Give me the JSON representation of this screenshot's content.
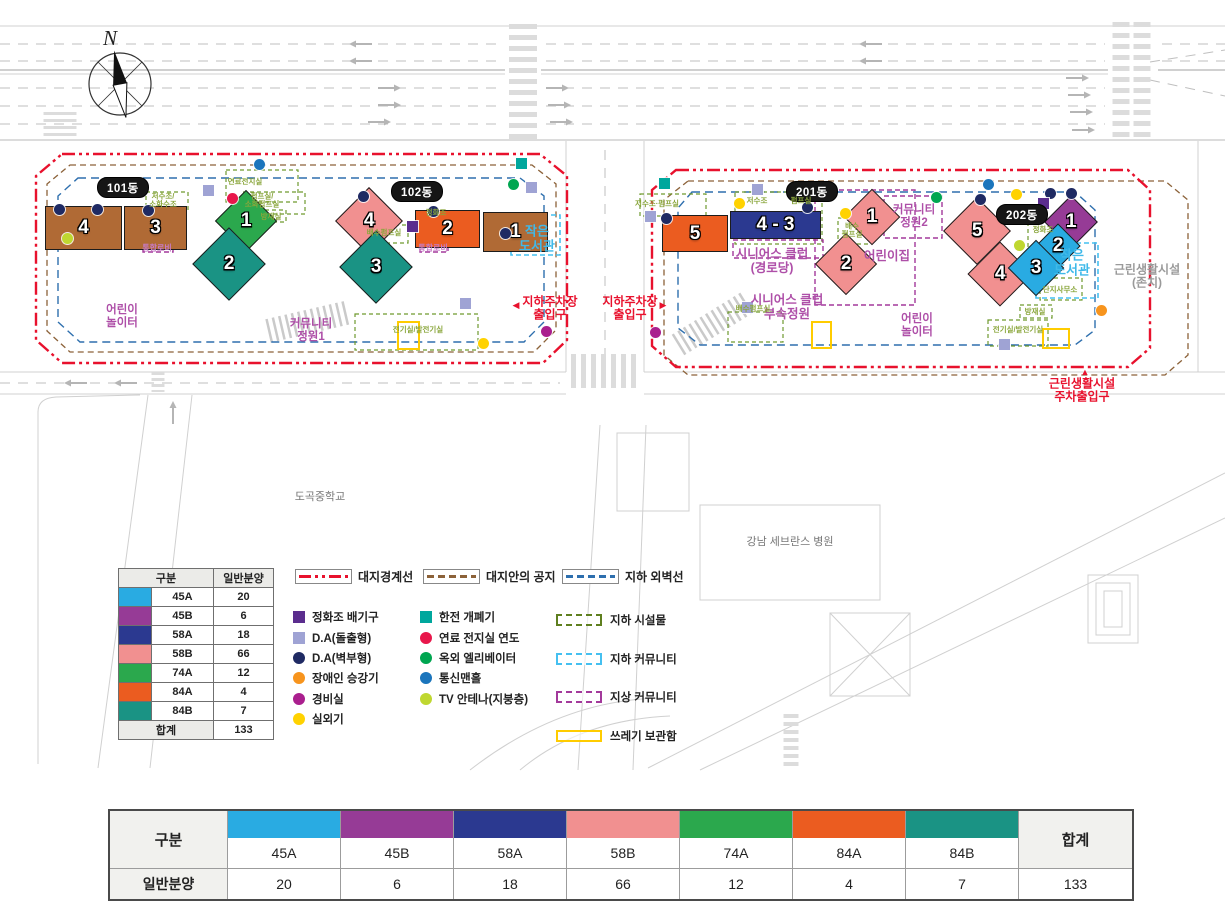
{
  "compass": {
    "label": "N"
  },
  "palette": {
    "boundary_red": "#E8112D",
    "setback_brown": "#8C6239",
    "basement_blue": "#2E6FAE",
    "rental_brown": "#B06A35"
  },
  "units": [
    {
      "type": "45A",
      "color": "#29ABE2",
      "sale": "20"
    },
    {
      "type": "45B",
      "color": "#963B96",
      "sale": "6"
    },
    {
      "type": "58A",
      "color": "#2B3990",
      "sale": "18"
    },
    {
      "type": "58B",
      "color": "#F19090",
      "sale": "66"
    },
    {
      "type": "74A",
      "color": "#2BA84D",
      "sale": "12"
    },
    {
      "type": "84A",
      "color": "#EB5C20",
      "sale": "4"
    },
    {
      "type": "84B",
      "color": "#1A9384",
      "sale": "7"
    }
  ],
  "legend_table": {
    "header_type": "구분",
    "header_sale": "일반분양",
    "total_label": "합계",
    "total_value": "133"
  },
  "bottom_table": {
    "row_type_label": "구분",
    "row_sale_label": "일반분양",
    "total_label": "합계",
    "total_value": "133"
  },
  "legend_lines": [
    {
      "id": "site-boundary",
      "label": "대지경계선",
      "color": "#E8112D",
      "style": "dashdot",
      "x": 295
    },
    {
      "id": "site-open-space",
      "label": "대지안의 공지",
      "color": "#8C6239",
      "style": "dash",
      "x": 423
    },
    {
      "id": "basement-wall",
      "label": "지하 외벽선",
      "color": "#2E6FAE",
      "style": "dash",
      "x": 562
    }
  ],
  "legend_symbols_left": [
    {
      "id": "septic-vent",
      "shape": "square",
      "color": "#5B2D8E",
      "label": "정화조 배기구"
    },
    {
      "id": "da-protruding",
      "shape": "square",
      "color": "#9FA3D4",
      "label": "D.A(돌출형)"
    },
    {
      "id": "da-wall",
      "shape": "circle",
      "color": "#1F2A63",
      "label": "D.A(벽부형)"
    },
    {
      "id": "disabled-lift",
      "shape": "circle",
      "color": "#F7941D",
      "label": "장애인 승강기"
    },
    {
      "id": "guard-room",
      "shape": "circle",
      "color": "#AA1F8E",
      "label": "경비실"
    },
    {
      "id": "outdoor-unit",
      "shape": "circle",
      "color": "#FFD200",
      "label": "실외기"
    }
  ],
  "legend_symbols_right": [
    {
      "id": "kepco-switch",
      "shape": "square",
      "color": "#00A79D",
      "label": "한전 개폐기"
    },
    {
      "id": "fuel-cell-flue",
      "shape": "circle",
      "color": "#E8174B",
      "label": "연료 전지실 연도"
    },
    {
      "id": "outdoor-elevator",
      "shape": "circle",
      "color": "#00A651",
      "label": "옥외 엘리베이터"
    },
    {
      "id": "comm-manhole",
      "shape": "circle",
      "color": "#1B75BC",
      "label": "통신맨홀"
    },
    {
      "id": "tv-antenna",
      "shape": "circle",
      "color": "#BFD730",
      "label": "TV 안테나(지붕층)"
    }
  ],
  "legend_areas": [
    {
      "id": "underground-facility",
      "color": "#5E7F1F",
      "style": "dashed",
      "label": "지하 시설물"
    },
    {
      "id": "underground-community",
      "color": "#45C0F0",
      "style": "dashed",
      "label": "지하 커뮤니티"
    },
    {
      "id": "ground-community",
      "color": "#A3399B",
      "style": "dashed",
      "label": "지상 커뮤니티"
    },
    {
      "id": "trash-storage",
      "color": "#FFCC00",
      "style": "solid",
      "label": "쓰레기 보관함"
    }
  ],
  "site": {
    "badges": [
      {
        "block": "101",
        "label": "101동",
        "x": 97,
        "y": 177
      },
      {
        "block": "102",
        "label": "102동",
        "x": 391,
        "y": 181
      },
      {
        "block": "201",
        "label": "201동",
        "x": 786,
        "y": 181
      },
      {
        "block": "202",
        "label": "202동",
        "x": 996,
        "y": 204
      }
    ],
    "buildings": [
      {
        "block": "101",
        "label": "4",
        "shape": "rect",
        "x": 45,
        "y": 206,
        "w": 77,
        "h": 44,
        "color": "#B06A35"
      },
      {
        "block": "101",
        "label": "3",
        "shape": "rect",
        "x": 124,
        "y": 206,
        "w": 63,
        "h": 44,
        "color": "#B06A35"
      },
      {
        "block": "101",
        "label": "1",
        "shape": "diamond",
        "cx": 246,
        "cy": 221,
        "size": 44,
        "color": "#2BA84D"
      },
      {
        "block": "101",
        "label": "2",
        "shape": "diamond",
        "cx": 229,
        "cy": 264,
        "size": 52,
        "color": "#1A9384"
      },
      {
        "block": "102",
        "label": "4",
        "shape": "diamond",
        "cx": 369,
        "cy": 221,
        "size": 48,
        "color": "#F19090"
      },
      {
        "block": "102",
        "label": "3",
        "shape": "diamond",
        "cx": 376,
        "cy": 267,
        "size": 52,
        "color": "#1A9384"
      },
      {
        "block": "102",
        "label": "2",
        "shape": "rect",
        "x": 415,
        "y": 210,
        "w": 65,
        "h": 38,
        "color": "#EB5C20"
      },
      {
        "block": "102",
        "label": "1",
        "shape": "rect",
        "x": 483,
        "y": 212,
        "w": 65,
        "h": 40,
        "color": "#B06A35"
      },
      {
        "block": "201",
        "label": "5",
        "shape": "rect",
        "x": 662,
        "y": 215,
        "w": 66,
        "h": 37,
        "color": "#EB5C20"
      },
      {
        "block": "201",
        "label": "4 - 3",
        "shape": "rect",
        "x": 730,
        "y": 211,
        "w": 91,
        "h": 28,
        "color": "#2B3990"
      },
      {
        "block": "201",
        "label": "1",
        "shape": "diamond",
        "cx": 872,
        "cy": 217,
        "size": 40,
        "color": "#F19090"
      },
      {
        "block": "201",
        "label": "2",
        "shape": "diamond",
        "cx": 846,
        "cy": 264,
        "size": 44,
        "color": "#F19090"
      },
      {
        "block": "202",
        "label": "5",
        "shape": "diamond",
        "cx": 977,
        "cy": 231,
        "size": 48,
        "color": "#F19090"
      },
      {
        "block": "202",
        "label": "4",
        "shape": "diamond",
        "cx": 1000,
        "cy": 274,
        "size": 46,
        "color": "#F19090"
      },
      {
        "block": "202",
        "label": "1",
        "shape": "diamond",
        "cx": 1071,
        "cy": 222,
        "size": 38,
        "color": "#963B96"
      },
      {
        "block": "202",
        "label": "2",
        "shape": "diamond",
        "cx": 1058,
        "cy": 246,
        "size": 32,
        "color": "#29ABE2"
      },
      {
        "block": "202",
        "label": "3",
        "shape": "diamond",
        "cx": 1036,
        "cy": 268,
        "size": 40,
        "color": "#29ABE2"
      }
    ],
    "markers": [
      {
        "type": "comm-manhole",
        "x": 259,
        "y": 164
      },
      {
        "type": "da-wall",
        "x": 59,
        "y": 209
      },
      {
        "type": "da-wall",
        "x": 97,
        "y": 209
      },
      {
        "type": "da-wall",
        "x": 148,
        "y": 210
      },
      {
        "type": "tv-antenna",
        "x": 67,
        "y": 238
      },
      {
        "type": "da-protruding",
        "x": 208,
        "y": 190
      },
      {
        "type": "fuel-cell-flue",
        "x": 232,
        "y": 198
      },
      {
        "type": "da-wall",
        "x": 363,
        "y": 196
      },
      {
        "type": "septic-vent",
        "x": 412,
        "y": 226
      },
      {
        "type": "da-wall",
        "x": 433,
        "y": 211
      },
      {
        "type": "da-wall",
        "x": 505,
        "y": 233
      },
      {
        "type": "kepco-switch",
        "x": 521,
        "y": 163
      },
      {
        "type": "outdoor-elevator",
        "x": 513,
        "y": 184
      },
      {
        "type": "da-protruding",
        "x": 531,
        "y": 187
      },
      {
        "type": "da-protruding",
        "x": 465,
        "y": 303
      },
      {
        "type": "guard-room",
        "x": 546,
        "y": 331
      },
      {
        "type": "outdoor-unit",
        "x": 483,
        "y": 343
      },
      {
        "type": "kepco-switch",
        "x": 664,
        "y": 183
      },
      {
        "type": "da-protruding",
        "x": 650,
        "y": 216
      },
      {
        "type": "da-wall",
        "x": 666,
        "y": 218
      },
      {
        "type": "da-protruding",
        "x": 757,
        "y": 189
      },
      {
        "type": "outdoor-unit",
        "x": 739,
        "y": 203
      },
      {
        "type": "da-wall",
        "x": 807,
        "y": 207
      },
      {
        "type": "outdoor-unit",
        "x": 845,
        "y": 213
      },
      {
        "type": "outdoor-elevator",
        "x": 936,
        "y": 197
      },
      {
        "type": "guard-room",
        "x": 655,
        "y": 332
      },
      {
        "type": "da-protruding",
        "x": 747,
        "y": 307
      },
      {
        "type": "comm-manhole",
        "x": 988,
        "y": 184
      },
      {
        "type": "outdoor-unit",
        "x": 1016,
        "y": 194
      },
      {
        "type": "da-wall",
        "x": 1050,
        "y": 193
      },
      {
        "type": "da-wall",
        "x": 1071,
        "y": 193
      },
      {
        "type": "da-wall",
        "x": 980,
        "y": 199
      },
      {
        "type": "septic-vent",
        "x": 1043,
        "y": 203
      },
      {
        "type": "tv-antenna",
        "x": 1019,
        "y": 245
      },
      {
        "type": "disabled-lift",
        "x": 1101,
        "y": 310
      },
      {
        "type": "da-protruding",
        "x": 1004,
        "y": 344
      }
    ],
    "labels": [
      {
        "name": "playground-101-label",
        "style": "amenity",
        "x": 122,
        "y": 317,
        "text": "어린이\n놀이터"
      },
      {
        "name": "community-garden1-label",
        "style": "amenity",
        "x": 311,
        "y": 331,
        "text": "커뮤니티\n정원1"
      },
      {
        "name": "library-102-label",
        "style": "library",
        "x": 537,
        "y": 239,
        "text": "작은\n도서관"
      },
      {
        "name": "parking-entrance-west-label",
        "style": "entry",
        "x": 550,
        "y": 309,
        "text": "지하주차장\n출입구"
      },
      {
        "name": "parking-entrance-west-arrow",
        "style": "entry-arrow",
        "x": 516,
        "y": 305,
        "text": "◀"
      },
      {
        "name": "parking-entrance-east-label",
        "style": "entry",
        "x": 630,
        "y": 309,
        "text": "지하주차장\n출입구"
      },
      {
        "name": "parking-entrance-east-arrow",
        "style": "entry-arrow",
        "x": 663,
        "y": 305,
        "text": "▶"
      },
      {
        "name": "seniors-club-label",
        "style": "amenity-lg",
        "x": 772,
        "y": 261,
        "text": "시니어스 클럽\n(경로당)"
      },
      {
        "name": "daycare-label",
        "style": "amenity-lg",
        "x": 887,
        "y": 256,
        "text": "어린이집"
      },
      {
        "name": "community-garden2-label",
        "style": "amenity",
        "x": 914,
        "y": 217,
        "text": "커뮤니티\n정원2"
      },
      {
        "name": "seniors-club-garden-label",
        "style": "amenity-lg",
        "x": 787,
        "y": 307,
        "text": "시니어스 클럽\n부속정원"
      },
      {
        "name": "playground-201-label",
        "style": "amenity",
        "x": 917,
        "y": 326,
        "text": "어린이\n놀이터"
      },
      {
        "name": "library-202-label",
        "style": "library",
        "x": 1072,
        "y": 263,
        "text": "작은\n도서관"
      },
      {
        "name": "neighborhood-facility-label",
        "style": "keep",
        "x": 1147,
        "y": 277,
        "text": "근린생활시설\n(존치)"
      },
      {
        "name": "facility-parking-entrance-label",
        "style": "entry",
        "x": 1082,
        "y": 391,
        "text": "근린생활시설\n주차출입구"
      },
      {
        "name": "facility-parking-entrance-arrow",
        "style": "entry-arrow",
        "x": 1085,
        "y": 372,
        "text": "▲"
      },
      {
        "name": "dogok-middle-school-label",
        "style": "map-label",
        "x": 320,
        "y": 497,
        "text": "도곡중학교"
      },
      {
        "name": "gangnam-severance-hospital-label",
        "style": "map-label",
        "x": 790,
        "y": 542,
        "text": "강남 세브란스 병원"
      },
      {
        "name": "fuel-cell-room-label",
        "style": "facility",
        "x": 245,
        "y": 182,
        "text": "연료전지실"
      },
      {
        "name": "water-tank-101-label",
        "style": "facility",
        "x": 163,
        "y": 201,
        "text": "저수조/\n소화수조"
      },
      {
        "name": "pump-room-101-label",
        "style": "facility",
        "x": 262,
        "y": 201,
        "text": "펌프실/\n소화펌프실"
      },
      {
        "name": "disaster-room-101-label",
        "style": "facility",
        "x": 271,
        "y": 217,
        "text": "방재실"
      },
      {
        "name": "drain-pump-102-label",
        "style": "facility",
        "x": 384,
        "y": 233,
        "text": "배수펌프실"
      },
      {
        "name": "septic-102-label",
        "style": "facility",
        "x": 436,
        "y": 213,
        "text": "정화조"
      },
      {
        "name": "electrical-room-102-label",
        "style": "facility",
        "x": 418,
        "y": 330,
        "text": "전기실/발전기실"
      },
      {
        "name": "water-tank-pump-201-label",
        "style": "facility",
        "x": 657,
        "y": 204,
        "text": "저수조·펌프실"
      },
      {
        "name": "water-tank-201-label",
        "style": "facility",
        "x": 757,
        "y": 201,
        "text": "저수조"
      },
      {
        "name": "pump-room-201-label",
        "style": "facility",
        "x": 801,
        "y": 201,
        "text": "펌프실"
      },
      {
        "name": "drain-pump-201a-label",
        "style": "facility",
        "x": 852,
        "y": 231,
        "text": "배수\n펌프실"
      },
      {
        "name": "drain-pump-201b-label",
        "style": "facility",
        "x": 753,
        "y": 309,
        "text": "배수펌프실"
      },
      {
        "name": "septic-202-label",
        "style": "facility",
        "x": 1043,
        "y": 230,
        "text": "정화조"
      },
      {
        "name": "complex-office-202-label",
        "style": "facility",
        "x": 1060,
        "y": 290,
        "text": "단지사무소"
      },
      {
        "name": "disaster-room-202-label",
        "style": "facility",
        "x": 1035,
        "y": 312,
        "text": "방재실"
      },
      {
        "name": "electrical-room-202-label",
        "style": "facility",
        "x": 1018,
        "y": 330,
        "text": "전기실/발전기실"
      },
      {
        "name": "lobby-101-label",
        "style": "lobby",
        "x": 157,
        "y": 249,
        "text": "통합로비"
      },
      {
        "name": "lobby-102-label",
        "style": "lobby",
        "x": 433,
        "y": 249,
        "text": "통합로비"
      }
    ]
  }
}
